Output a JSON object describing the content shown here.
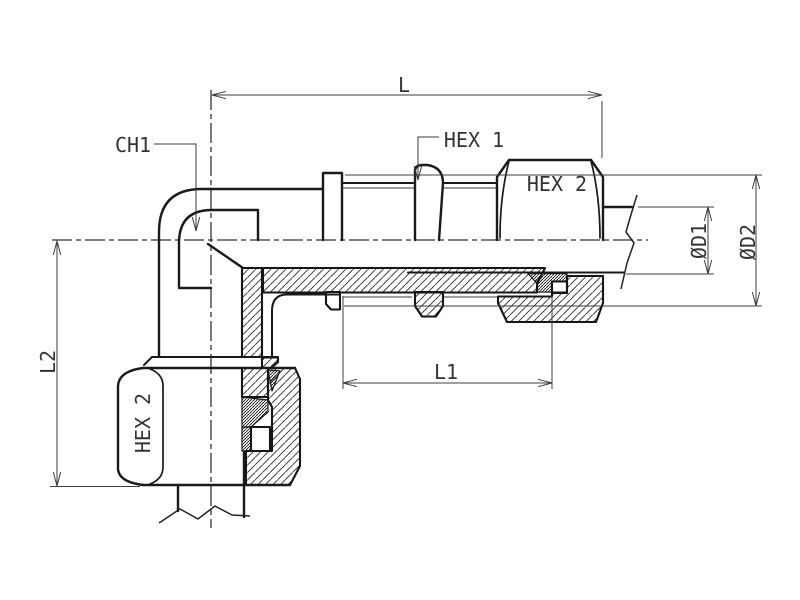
{
  "drawing": {
    "background": "#ffffff",
    "line_color": "#1a1a1a",
    "dimension_color": "#3d3d3d",
    "text_color": "#333333"
  },
  "labels": {
    "l": "L",
    "l1": "L1",
    "l2": "L2",
    "ch1": "CH1",
    "hex1": "HEX 1",
    "hex2_h": "HEX 2",
    "hex2_v": "HEX 2",
    "d1": "ØD1",
    "d2": "ØD2"
  }
}
